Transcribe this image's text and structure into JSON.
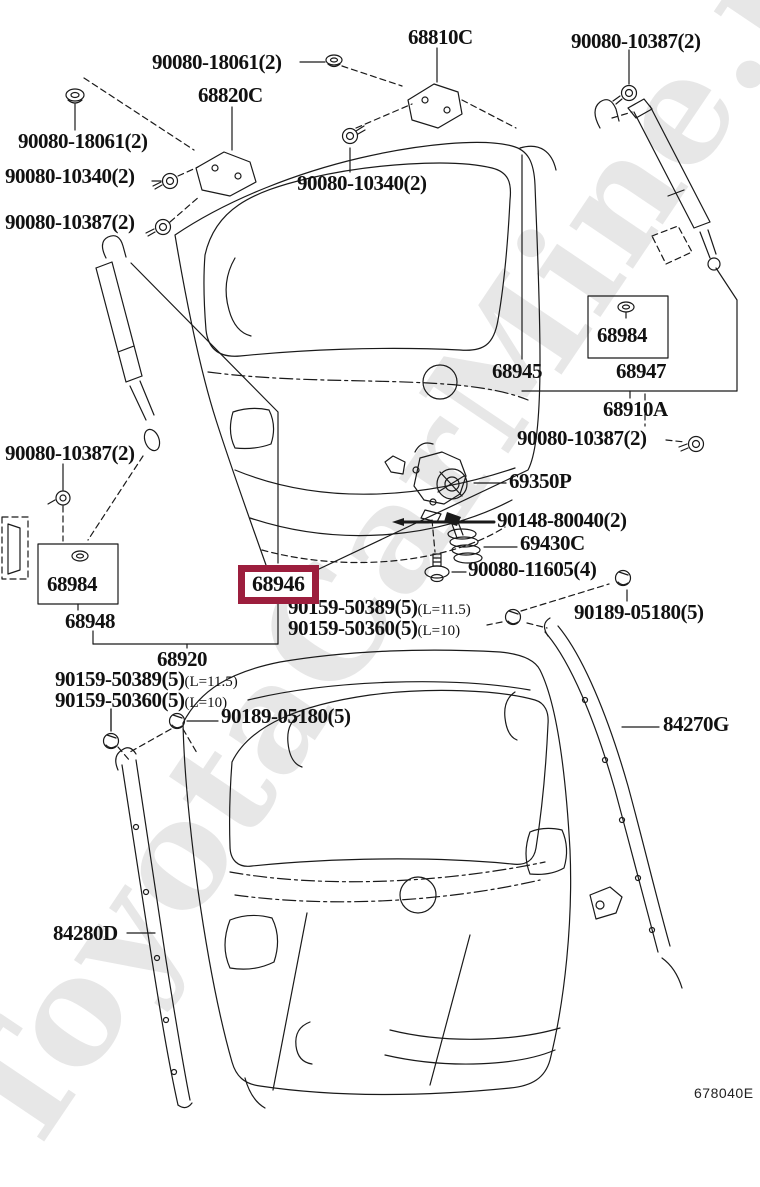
{
  "watermark": "ToyotaCarMine.ru",
  "diagram_code": "678040E",
  "highlight_color": "#9c1e3d",
  "highlighted_part": "68946",
  "parts": {
    "n68810C": "68810C",
    "n68820C": "68820C",
    "n68945": "68945",
    "n68984": "68984",
    "n68947": "68947",
    "n68910A": "68910A",
    "n68946": "68946",
    "n68948": "68948",
    "n68920": "68920",
    "n69350P": "69350P",
    "n69430C": "69430C",
    "n84270G": "84270G",
    "n84280D": "84280D",
    "b18061": "90080-18061(2)",
    "b10340": "90080-10340(2)",
    "b10387": "90080-10387(2)",
    "b11605": "90080-11605(4)",
    "b80040": "90148-80040(2)",
    "s50389": "90159-50389(5)",
    "s50360": "90159-50360(5)",
    "qL115": "(L=11.5)",
    "qL10": "(L=10)",
    "c05180": "90189-05180(5)"
  }
}
